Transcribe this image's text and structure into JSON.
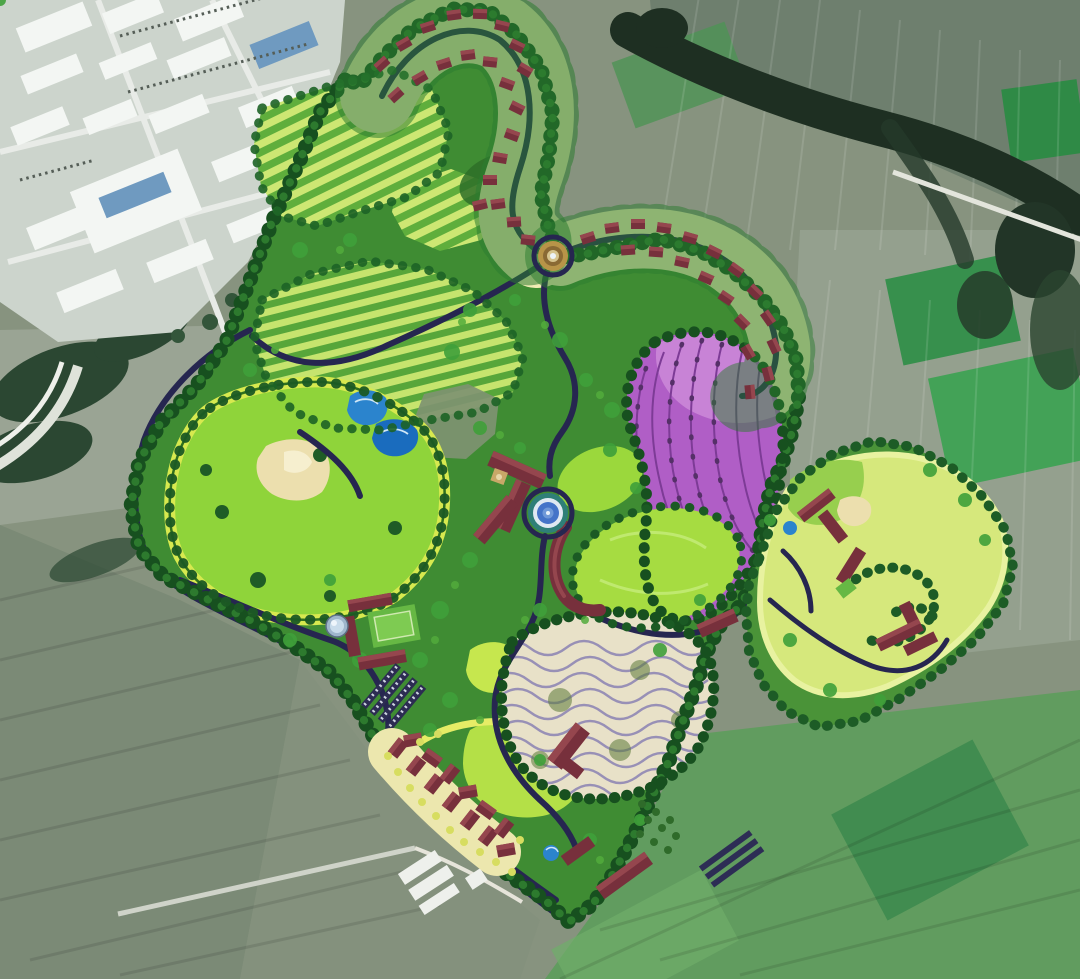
{
  "meta": {
    "title": "Resort master plan aerial rendering over satellite farmland",
    "kind": "site-plan-overlay",
    "width_px": 1080,
    "height_px": 979
  },
  "colors": {
    "satellite_base": "#87937f",
    "satellite_pale": "#9aa494",
    "field_gray": "#6e7f6e",
    "field_green_dark": "#37904d",
    "field_green_mid": "#43a257",
    "bottomright_green": "#619c5f",
    "industrial_pad": "#ccd4cc",
    "roof_white": "#f3f6f3",
    "roof_blue": "#6f9ac0",
    "river_dark": "#1e2f22",
    "white_road": "#e3e5dc",
    "site_green": "#3f8c33",
    "lobe_green": "#4a9338",
    "tree_dark": "#17501f",
    "tree_mid": "#2d7a2e",
    "tree_light": "#52ab3c",
    "terrace_light": "#cde773",
    "terrace_dark": "#5fae3c",
    "cream": "#f1ecb4",
    "maroon": "#77303c",
    "maroon_light": "#95464e",
    "road_navy": "#262650",
    "gold": "#b89448",
    "purple": "#b05ec6",
    "purple_light": "#cc8ad8",
    "purple_row": "#7d3b96",
    "meadow": "#8fd43a",
    "meadow_ring": "#d7e94f",
    "meadow_edge": "#2f6f1e",
    "lawn": "#a6dc41",
    "lawn_bright": "#b4e047",
    "sand": "#ecdfae",
    "water": "#2b84cd",
    "plaza_teal": "#2f7f78",
    "plaza_blue": "#4474c8",
    "plaza_pale": "#dfe9f2",
    "swirl": "#e8e1c8",
    "swirl_line": "#9088b4",
    "court": "#66b844",
    "parking": "#2c2c52",
    "dome": "#9fb6cc",
    "yellow_dot": "#d7dd60",
    "rock_gray": "#7e9271"
  },
  "features": [
    {
      "id": "satellite-farmland",
      "label": "surrounding farmland parcels",
      "color": "#87937f"
    },
    {
      "id": "industrial-district",
      "label": "factory district top-left",
      "color": "#f3f6f3"
    },
    {
      "id": "forest-riverline",
      "label": "dark tree line along creek",
      "color": "#1e2f22"
    },
    {
      "id": "resort-site",
      "label": "master-plan site with tree border",
      "color": "#3f8c33"
    },
    {
      "id": "terraced-fields",
      "label": "striped terrace plantings",
      "color": "#cde773"
    },
    {
      "id": "hillside-villas",
      "label": "villa ribbon with red roofs",
      "color": "#77303c"
    },
    {
      "id": "entry-roundabout",
      "label": "circular entry roundabout",
      "color": "#b89448"
    },
    {
      "id": "lavender-flower-field",
      "label": "purple flower field",
      "color": "#b05ec6"
    },
    {
      "id": "central-meadow",
      "label": "large bright meadow with sand beach",
      "color": "#8fd43a"
    },
    {
      "id": "water-pools",
      "label": "blue water pools",
      "color": "#2b84cd"
    },
    {
      "id": "main-lodge-complex",
      "label": "central lodge buildings",
      "color": "#77303c"
    },
    {
      "id": "central-plaza-fountain",
      "label": "round plaza with fountain",
      "color": "#4474c8"
    },
    {
      "id": "swirl-terraces",
      "label": "wavy terraced garden",
      "color": "#e8e1c8"
    },
    {
      "id": "village-cluster",
      "label": "south-west village cluster",
      "color": "#77303c"
    },
    {
      "id": "east-meadow-lobe",
      "label": "eastern golf meadow lobe",
      "color": "#d6e87c"
    },
    {
      "id": "site-roads",
      "label": "dark looping site roads",
      "color": "#262650"
    },
    {
      "id": "white-country-road",
      "label": "white rural roads",
      "color": "#e3e5dc"
    }
  ]
}
